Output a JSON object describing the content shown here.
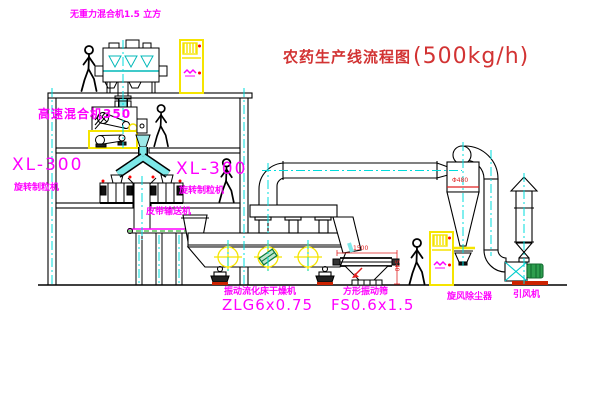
{
  "title": {
    "name": "农药生产线流程图",
    "capacity": "(500kg/h)"
  },
  "equipment_labels": {
    "gravity_mixer": "无重力混合机1.5 立方",
    "high_speed_mixer": "高速混合机350",
    "granulator_left_model": "XL-300",
    "granulator_left_name": "旋转制粒机",
    "granulator_right_model": "XL-300",
    "granulator_right_name": "旋转制粒机",
    "belt_conveyor": "皮带输送机",
    "dryer_name": "振动流化床干燥机",
    "dryer_model": "ZLG6x0.75",
    "sieve_name": "方形振动筛",
    "sieve_model": "FS0.6x1.5",
    "cyclone": "旋风除尘器",
    "fan": "引风机"
  },
  "dimensions": {
    "sieve_length": "1500",
    "sieve_height": "540",
    "cyclone_diameter": "Φ480"
  },
  "colors": {
    "label_magenta": "#ff00ff",
    "title_red": "#d23333",
    "centerline_cyan": "#00dcdc",
    "cabinet_yellow": "#ffff00",
    "drawing_black": "#000000",
    "accent_green": "#00aa00",
    "base_red": "#cc2200"
  }
}
